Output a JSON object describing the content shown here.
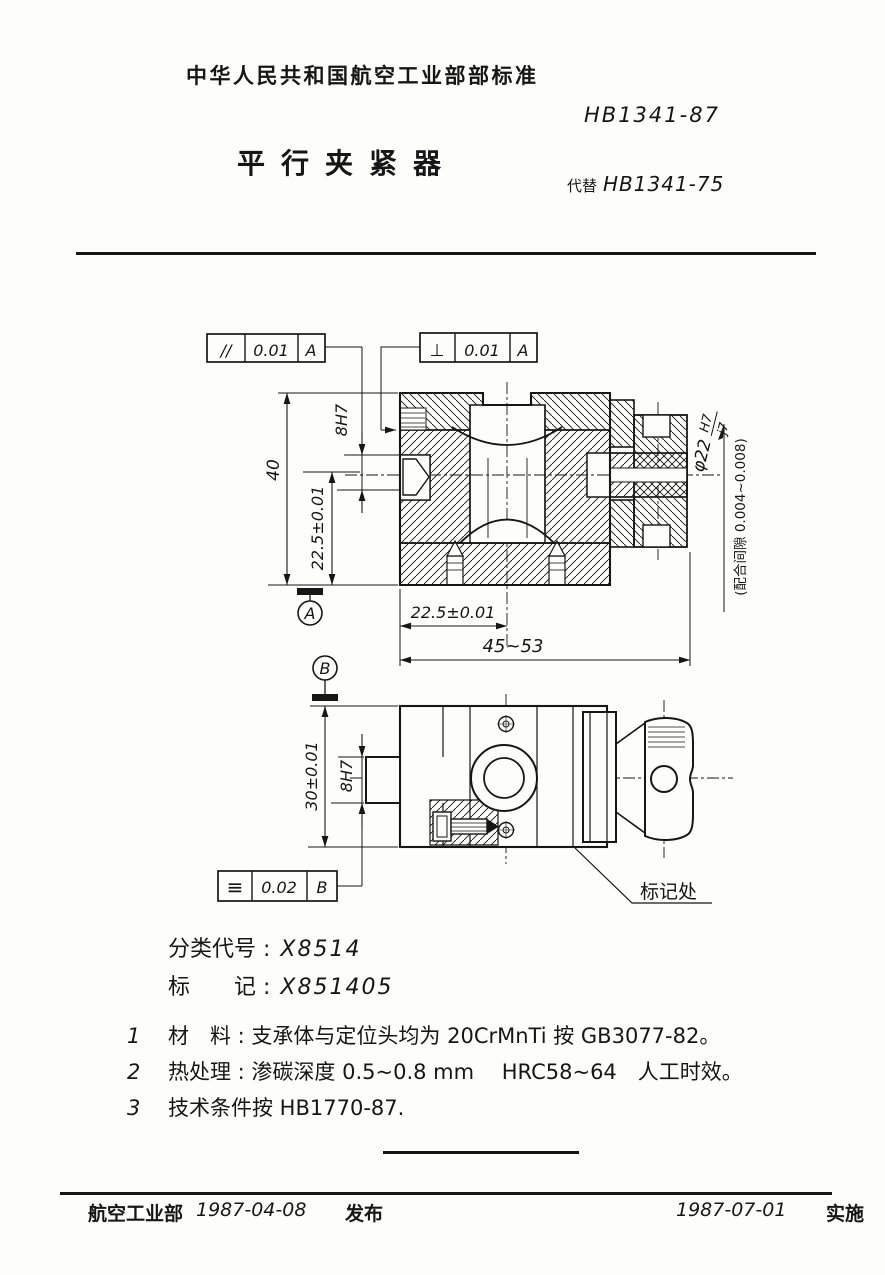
{
  "header": {
    "standard_org": "中华人民共和国航空工业部部标准",
    "standard_no": "HB1341-87",
    "title": "平行夹紧器",
    "supersede_label": "代替",
    "supersede_no": "HB1341-75"
  },
  "drawing": {
    "fcf": {
      "parallel": {
        "symbol": "//",
        "value": "0.01",
        "datum": "A"
      },
      "perp": {
        "symbol": "⊥",
        "value": "0.01",
        "datum": "A"
      },
      "symmetry": {
        "symbol": "≡",
        "value": "0.02",
        "datum": "B"
      }
    },
    "datum_a": "A",
    "datum_b": "B",
    "dims": {
      "height_total": "40",
      "height_half": "22.5±0.01",
      "bore_top": "8H7",
      "width_half": "22.5±0.01",
      "width_range": "45~53",
      "height_30": "30±0.01",
      "bore_bottom": "8H7",
      "fit_dia": "φ22",
      "fit_hole": "H7",
      "fit_shaft": "j7",
      "fit_note": "(配合间隙 0.004~0.008)",
      "mark_here": "标记处"
    },
    "ink_color": "#161616",
    "paper_color": "#fdfdfc"
  },
  "classification": {
    "code_label": "分类代号 :",
    "code_value": "X8514",
    "mark_label": "标　　记 :",
    "mark_value": "X851405"
  },
  "notes": [
    {
      "no": "1",
      "text": "材　料 : 支承体与定位头均为 20CrMnTi 按 GB3077-82。"
    },
    {
      "no": "2",
      "text": "热处理 : 渗碳深度 0.5~0.8 mm　 HRC58~64　人工时效。"
    },
    {
      "no": "3",
      "text": "技术条件按 HB1770-87."
    }
  ],
  "footer": {
    "org": "航空工业部",
    "release_date": "1987-04-08",
    "release_label": "发布",
    "impl_date": "1987-07-01",
    "impl_label": "实施"
  }
}
